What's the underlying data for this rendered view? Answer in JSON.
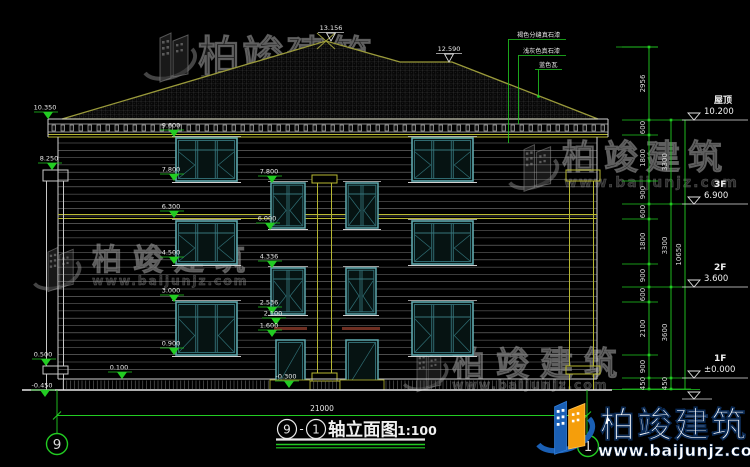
{
  "watermark": {
    "brand": "柏竣建筑",
    "url": "www.baijunjz.com"
  },
  "title_block": {
    "axis_start": "9",
    "separator": "-",
    "axis_end": "1",
    "name": "轴立面图",
    "scale": "1:100"
  },
  "grid_bubbles": {
    "left": "9",
    "right": "1"
  },
  "dims": {
    "width": "21000",
    "overall": "10650",
    "inner": [
      "2956",
      "600",
      "1800",
      "900",
      "600",
      "1800",
      "900",
      "600",
      "2100",
      "900",
      "450"
    ],
    "mid": [
      "3300",
      "3300",
      "3600",
      "450"
    ]
  },
  "floor_marks": [
    {
      "name": "屋顶",
      "value": "10.200",
      "y": 120
    },
    {
      "name": "3F",
      "value": "6.900",
      "y": 204
    },
    {
      "name": "2F",
      "value": "3.600",
      "y": 287
    },
    {
      "name": "1F",
      "value": "±0.000",
      "y": 378
    }
  ],
  "roof_marks": [
    {
      "text": "13.156",
      "x": 331,
      "y": 41
    },
    {
      "text": "12.590",
      "x": 449,
      "y": 62
    }
  ],
  "facade_marks": [
    {
      "text": "10.350",
      "x": 48,
      "y": 119
    },
    {
      "text": "8.250",
      "x": 52,
      "y": 170
    },
    {
      "text": "0.500",
      "x": 46,
      "y": 366
    },
    {
      "text": "-0.450",
      "x": 45,
      "y": 397
    },
    {
      "text": "0.100",
      "x": 122,
      "y": 379
    },
    {
      "text": "9.600",
      "x": 174,
      "y": 137
    },
    {
      "text": "7.800",
      "x": 174,
      "y": 181
    },
    {
      "text": "6.300",
      "x": 174,
      "y": 218
    },
    {
      "text": "4.500",
      "x": 174,
      "y": 264
    },
    {
      "text": "3.000",
      "x": 174,
      "y": 302
    },
    {
      "text": "0.900",
      "x": 174,
      "y": 355
    },
    {
      "text": "7.800",
      "x": 272,
      "y": 183
    },
    {
      "text": "6.000",
      "x": 270,
      "y": 230
    },
    {
      "text": "4.336",
      "x": 272,
      "y": 268
    },
    {
      "text": "2.536",
      "x": 272,
      "y": 314
    },
    {
      "text": "2.100",
      "x": 276,
      "y": 325
    },
    {
      "text": "1.600",
      "x": 272,
      "y": 337
    },
    {
      "text": "-0.300",
      "x": 289,
      "y": 388
    }
  ],
  "annotations": [
    {
      "text": "褐色分缝真石漆"
    },
    {
      "text": "浅灰色真石漆"
    },
    {
      "text": "蓝色瓦"
    }
  ]
}
